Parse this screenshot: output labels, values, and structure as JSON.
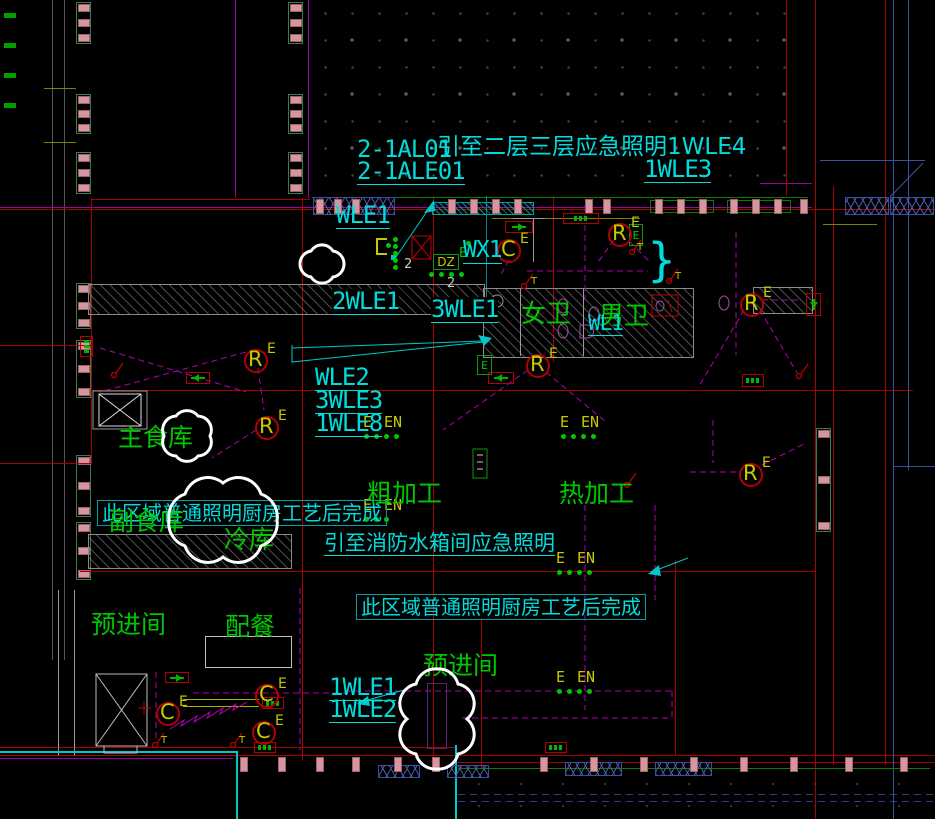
{
  "drawing": {
    "kind": "CAD electrical lighting floor plan - kitchen / toilet area"
  },
  "colors": {
    "background": "#000000",
    "circuit_text": "#00dcdc",
    "room_text": "#00c800",
    "symbol_text": "#c8c800",
    "red_line": "#a80000",
    "wiring_dashed": "#b400b4",
    "revision_cloud": "#ffffff",
    "mullion_pink": "#d497a0",
    "truss_blue": "#3c50a0"
  },
  "texts": {
    "t_2_1al01": "2-1AL01",
    "t_note_upper": "引至二层三层应急照明1WLE4",
    "t_2_1ale01": "2-1ALE01",
    "t_1wle3": "1WLE3",
    "t_wle1": "WLE1",
    "t_wx1": "WX1",
    "t_2wle1": "2WLE1",
    "t_3wle1": "3WLE1",
    "t_wl1": "WL1",
    "t_wle2": "WLE2",
    "t_3wle3": "3WLE3",
    "t_1wle8": "1WLE8",
    "t_1wle1": "1WLE1",
    "t_1wle2": "1WLE2"
  },
  "rooms": {
    "women_wc": "女卫",
    "men_wc": "男卫",
    "main_pantry": "主食库",
    "side_pantry": "副食库",
    "cold_store": "冷库",
    "rough_prep": "粗加工",
    "hot_prep": "热加工",
    "pre_entry_left": "预进间",
    "serving": "配餐",
    "pre_entry_mid": "预进间"
  },
  "notes": {
    "region_left": "此区域普通照明厨房工艺后完成",
    "fire_tank": "引至消防水箱间应急照明",
    "region_mid": "此区域普通照明厨房工艺后完成"
  },
  "marks": {
    "r": "R",
    "c": "C",
    "e": "E",
    "en": "EN",
    "t": "T",
    "dz": "DZ",
    "brace": "}",
    "wire2a": "2",
    "wire2b": "2"
  }
}
